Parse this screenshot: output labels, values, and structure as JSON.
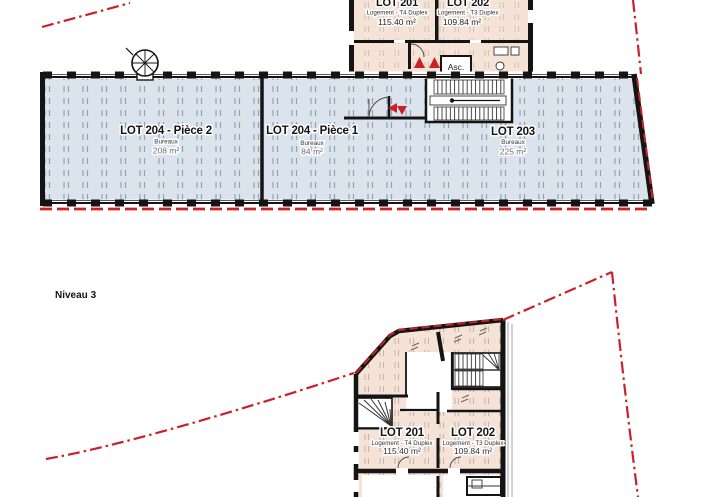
{
  "canvas": {
    "width": 706,
    "height": 497,
    "background": "#ffffff"
  },
  "colors": {
    "wall": "#141414",
    "boundary_red": "#cb2027",
    "office_fill": "#dbe3ed",
    "dwelling_fill": "#f6e3d7",
    "area_text_gray": "#6f6f6f"
  },
  "labels": {
    "level": "Niveau 3",
    "elevator": "Asc."
  },
  "lots": {
    "lot201": {
      "name": "LOT 201",
      "type": "Logement - T4 Duplex",
      "area": "115.40 m²"
    },
    "lot202": {
      "name": "LOT 202",
      "type": "Logement - T3 Duplex",
      "area": "109.84 m²"
    },
    "lot203": {
      "name": "LOT 203",
      "type": "Bureaux",
      "area": "225 m²"
    },
    "lot204_piece1": {
      "name": "LOT 204 - Pièce 1",
      "type": "Bureaux",
      "area": "84 m²"
    },
    "lot204_piece2": {
      "name": "LOT 204 - Pièce 2",
      "type": "Bureaux",
      "area": "208 m²"
    }
  }
}
